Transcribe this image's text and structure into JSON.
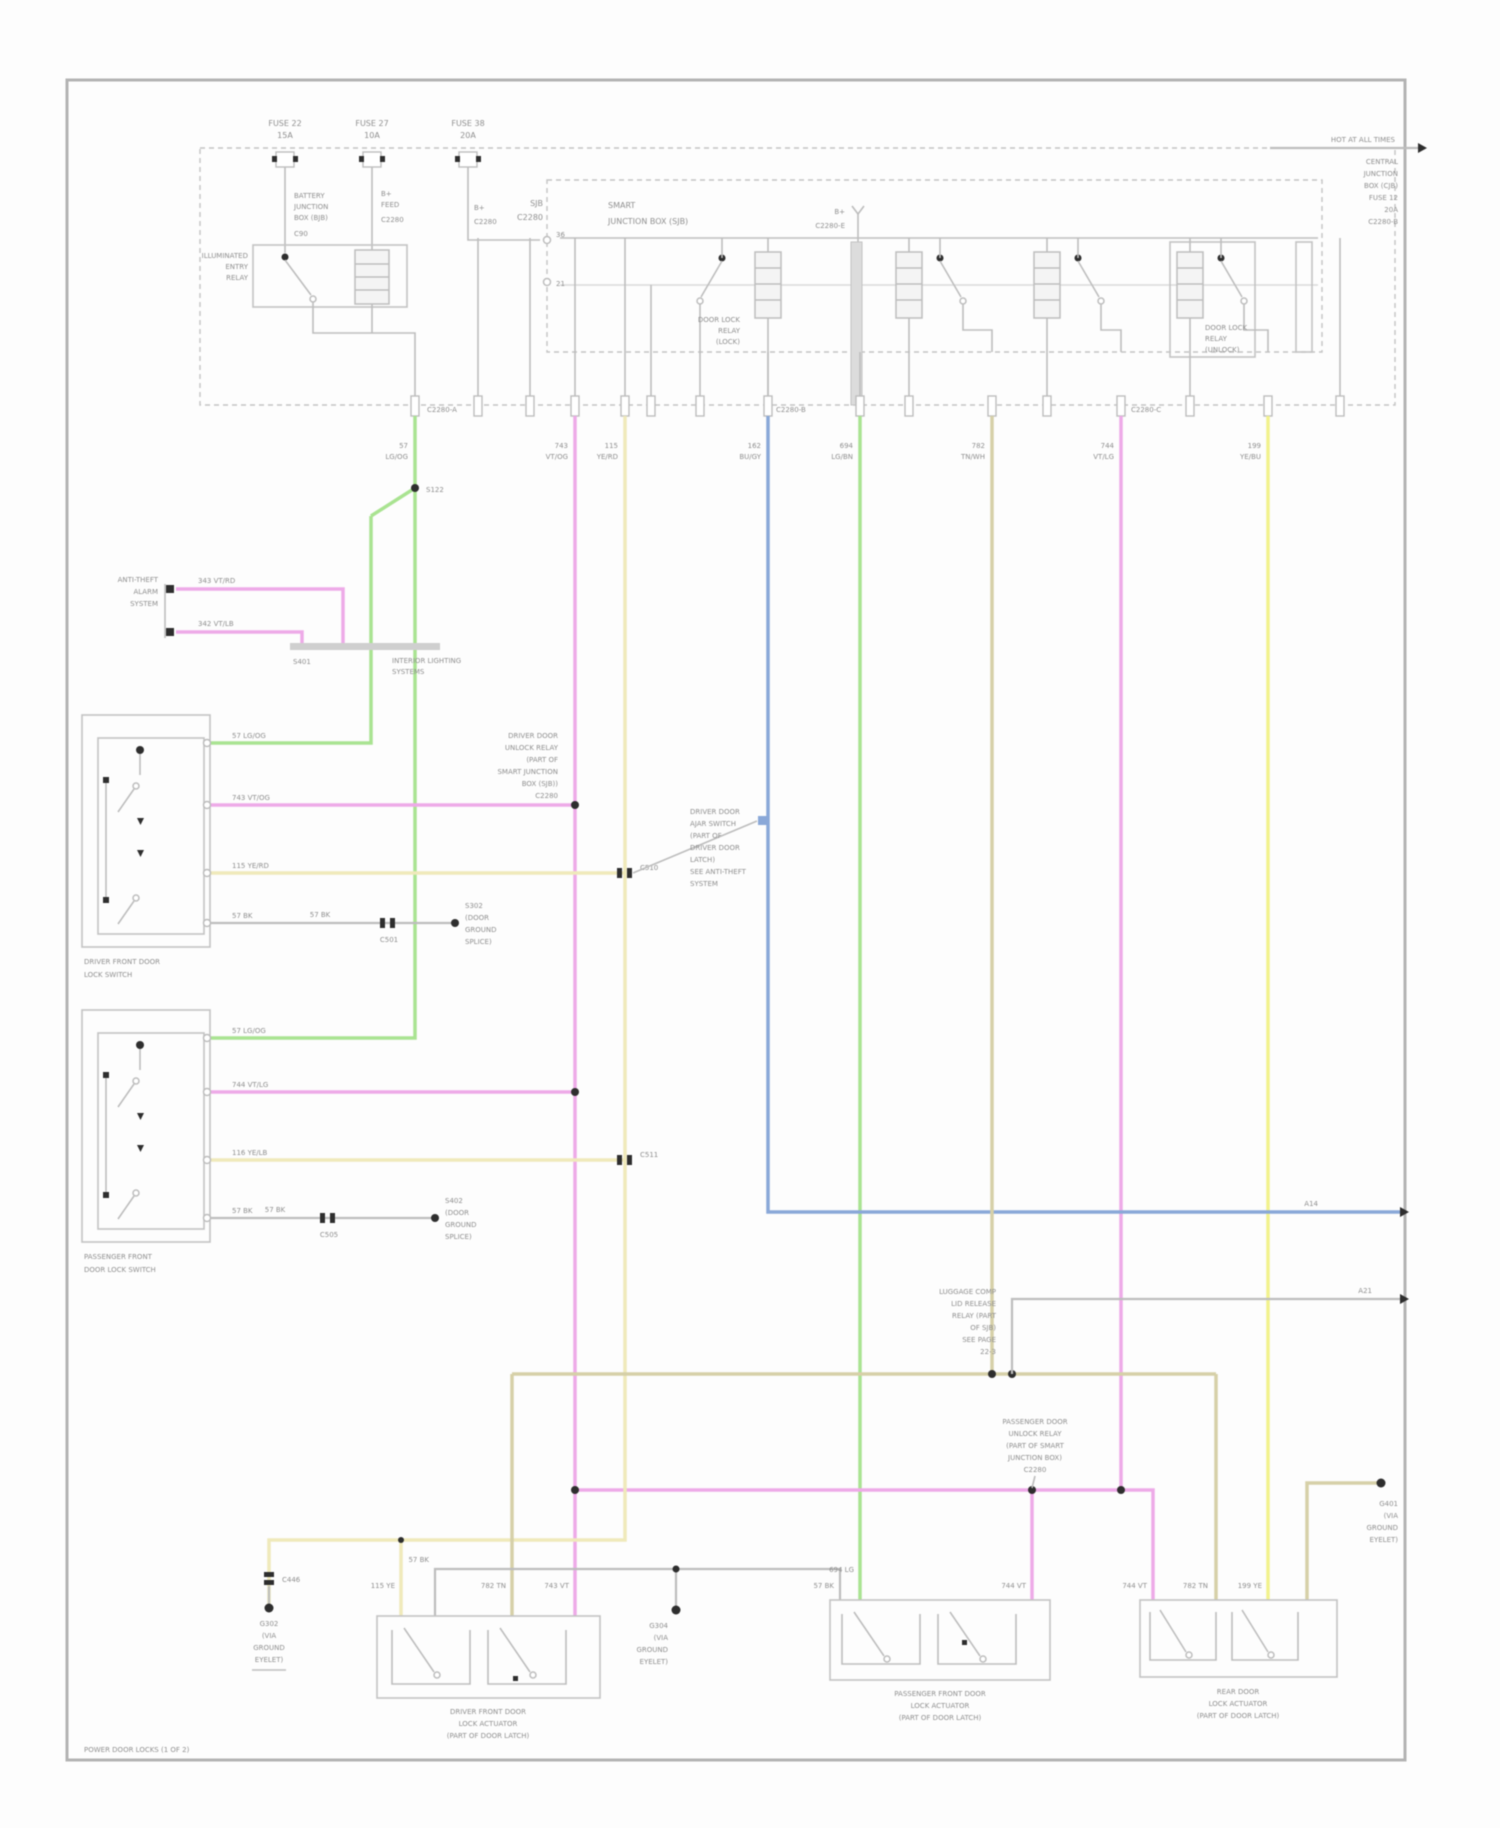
{
  "diagram_title": "POWER DOOR LOCKS (1 OF 2)",
  "colors": {
    "green": "#a9e391",
    "pink": "#eeaae8",
    "yellow": "#f2f28e",
    "paleyellow": "#efe9bb",
    "blue": "#8aa8d8",
    "tan": "#d6d0a8",
    "gray_wire": "#bdbdbd",
    "box_stroke": "#c3c3c3",
    "text": "#8f8f8f",
    "dot": "#2e2e2e",
    "border": "#b3b3b3"
  },
  "L": {
    "fuse1": [
      "FUSE 22",
      "15A"
    ],
    "fuse2": [
      "FUSE 27",
      "10A"
    ],
    "fuse3": [
      "FUSE 38",
      "20A"
    ],
    "f1block": [
      "BATTERY",
      "JUNCTION",
      "BOX (BJB)"
    ],
    "f1tick": "C90",
    "f2block": [
      "B+",
      "FEED"
    ],
    "f2tick": "C2280",
    "f3block": [
      "B+"
    ],
    "f3tick": "C2280",
    "relay": [
      "ILLUMINATED",
      "ENTRY",
      "RELAY"
    ],
    "sjb_frag": [
      "SJB",
      "C2280"
    ],
    "boxB_title": [
      "SMART",
      "JUNCTION BOX (SJB)"
    ],
    "bar_feed": [
      "B+",
      "C2280-E"
    ],
    "bb_pins": [
      "36",
      "21"
    ],
    "relayB1": [
      "DOOR LOCK",
      "RELAY",
      "(LOCK)"
    ],
    "relayB2": [
      "DOOR LOCK",
      "RELAY",
      "(UNLOCK)"
    ],
    "tr_line": "HOT AT ALL TIMES",
    "tr_block": [
      "CENTRAL",
      "JUNCTION",
      "BOX (CJB)",
      "FUSE 12",
      "20A",
      "C2280-B"
    ],
    "pin_c": [
      "C2280-A",
      "C2280-B",
      "C2280-C"
    ],
    "wc": [
      [
        "57",
        "LG/OG"
      ],
      [
        "743",
        "VT/OG"
      ],
      [
        "115",
        "YE/RD"
      ],
      [
        "162",
        "BU/GY"
      ],
      [
        "694",
        "LG/BN"
      ],
      [
        "782",
        "TN/WH"
      ],
      [
        "744",
        "VT/LG"
      ],
      [
        "199",
        "YE/BU"
      ]
    ],
    "s122": "S122",
    "theft": [
      "ANTI-THEFT",
      "ALARM",
      "SYSTEM"
    ],
    "theft_w": [
      "343 VT/RD",
      "342 VT/LB"
    ],
    "s401": "S401",
    "bar_right": [
      "INTERIOR LIGHTING",
      "SYSTEMS"
    ],
    "box1_pins": [
      "57 LG/OG",
      "743 VT/OG",
      "115 YE/RD",
      "57 BK"
    ],
    "box1_cap": [
      "DRIVER FRONT DOOR",
      "LOCK SWITCH"
    ],
    "box1_conn": "C501",
    "box1_gw": "57 BK",
    "box1_gnd": [
      "S302",
      "(DOOR",
      "GROUND",
      "SPLICE)"
    ],
    "box2_pins": [
      "57 LG/OG",
      "744 VT/LG",
      "116 YE/LB",
      "57 BK"
    ],
    "box2_cap": [
      "PASSENGER FRONT",
      "DOOR LOCK SWITCH"
    ],
    "box2_conn": "C505",
    "box2_gw": "57 BK",
    "box2_gnd": [
      "S402",
      "(DOOR",
      "GROUND",
      "SPLICE)"
    ],
    "c510": "C510",
    "c511": "C511",
    "unlock_relay": [
      "DRIVER DOOR",
      "UNLOCK RELAY",
      "(PART OF",
      "SMART JUNCTION",
      "BOX (SJB))",
      "C2280"
    ],
    "blue_block": [
      "DRIVER DOOR",
      "AJAR SWITCH",
      "(PART OF",
      "DRIVER DOOR",
      "LATCH)",
      "SEE ANTI-THEFT",
      "SYSTEM"
    ],
    "blue_end": "A14",
    "gray_end": "A21",
    "tan_block": [
      "LUGGAGE COMP",
      "LID RELEASE",
      "RELAY (PART",
      "OF SJB)",
      "SEE PAGE",
      "22-3"
    ],
    "pink_block": [
      "PASSENGER DOOR",
      "UNLOCK RELAY",
      "(PART OF SMART",
      "JUNCTION BOX)",
      "C2280"
    ],
    "g1": [
      "G302",
      "(VIA",
      "GROUND",
      "EYELET)"
    ],
    "g1c": "C446",
    "g2": [
      "G304",
      "(VIA",
      "GROUND",
      "EYELET)"
    ],
    "g3": [
      "G401",
      "(VIA",
      "GROUND",
      "EYELET)"
    ],
    "rc": [
      "115 YE",
      "57 BK",
      "782 TN",
      "743 VT",
      "57 BK",
      "694 LG",
      "744 VT",
      "744 VT",
      "782 TN",
      "199 YE"
    ],
    "act1_cap": [
      "DRIVER FRONT DOOR",
      "LOCK ACTUATOR",
      "(PART OF DOOR LATCH)"
    ],
    "act2_cap": [
      "PASSENGER FRONT DOOR",
      "LOCK ACTUATOR",
      "(PART OF DOOR LATCH)"
    ],
    "act3_cap": [
      "REAR DOOR",
      "LOCK ACTUATOR",
      "(PART OF DOOR LATCH)"
    ]
  }
}
